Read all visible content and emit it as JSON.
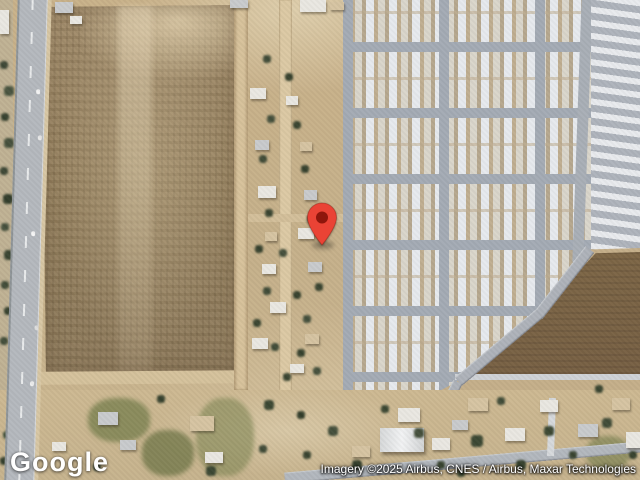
{
  "map": {
    "marker": {
      "color": "#EA4335",
      "dot_color": "#8E160C"
    }
  },
  "branding": {
    "logo_text": "Google"
  },
  "attribution": {
    "text": "Imagery ©2025 Airbus, CNES / Airbus, Maxar Technologies"
  },
  "palette": {
    "dirt": "#C8B28B",
    "tilled_field": "#97825F",
    "dark_field": "#7E6747",
    "highway": "#B5B9BE",
    "park_street": "#A4ABB4",
    "rooftop": "#EDEFF1",
    "vegetation": "#43503B"
  }
}
